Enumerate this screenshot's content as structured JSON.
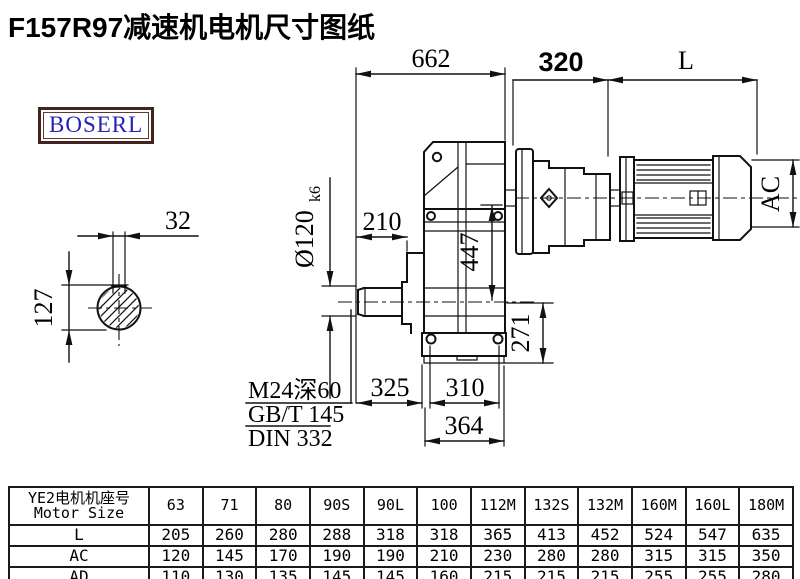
{
  "title": "F157R97减速机电机尺寸图纸",
  "logo": {
    "text": "BOSERL"
  },
  "drawing": {
    "dims": {
      "overall_length": "662",
      "adapter_length": "320",
      "motor_length_label": "L",
      "key_width": "32",
      "shaft_key_height": "127",
      "shaft_diameter": "Ø120",
      "shaft_tolerance": "k6",
      "shaft_extension": "210",
      "input_height": "447",
      "center_height": "271",
      "shaft_to_foot": "325",
      "foot_bolt_spacing": "310",
      "foot_width": "364",
      "motor_diameter_label": "AC"
    },
    "notes": {
      "tap": "M24深60",
      "gb": "GB/T 145",
      "din": "DIN 332"
    }
  },
  "table": {
    "header": {
      "line1": "YE2电机机座号",
      "line2": "Motor Size"
    },
    "columns": [
      "63",
      "71",
      "80",
      "90S",
      "90L",
      "100",
      "112M",
      "132S",
      "132M",
      "160M",
      "160L",
      "180M"
    ],
    "rows": [
      {
        "label": "L",
        "values": [
          "205",
          "260",
          "280",
          "288",
          "318",
          "318",
          "365",
          "413",
          "452",
          "524",
          "547",
          "635"
        ]
      },
      {
        "label": "AC",
        "values": [
          "120",
          "145",
          "170",
          "190",
          "190",
          "210",
          "230",
          "280",
          "280",
          "315",
          "315",
          "350"
        ]
      },
      {
        "label": "AD",
        "values": [
          "110",
          "130",
          "135",
          "145",
          "145",
          "160",
          "215",
          "215",
          "215",
          "255",
          "255",
          "280"
        ]
      }
    ]
  }
}
